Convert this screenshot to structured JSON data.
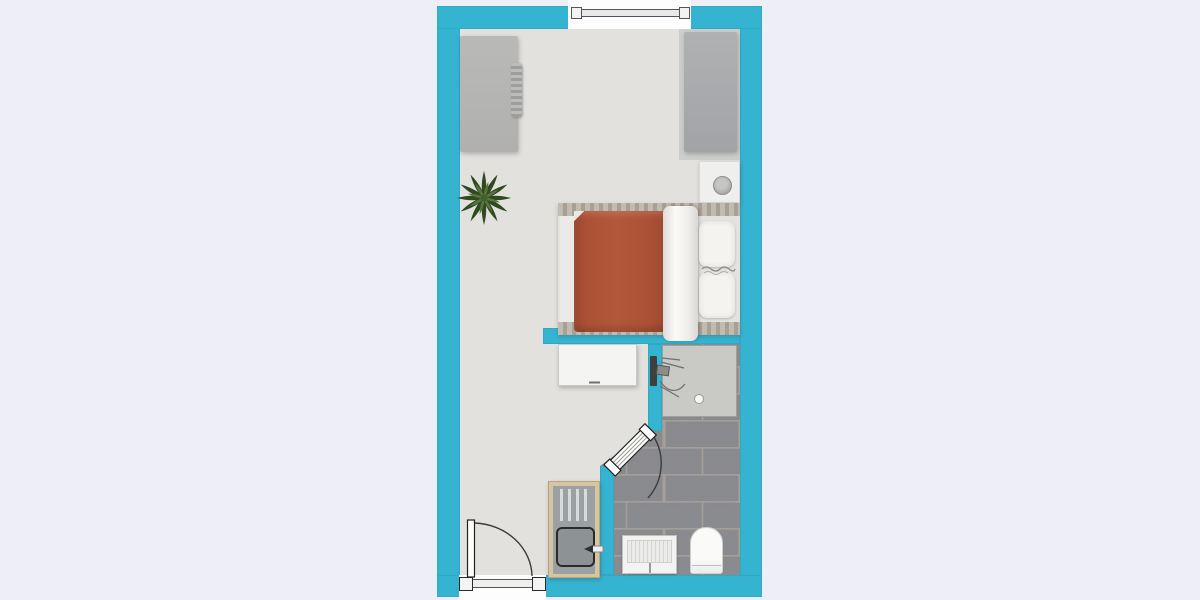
{
  "floorplan": {
    "type": "studio-apartment-floor-plan-top-view",
    "colors": {
      "page-bg": "#edeef6",
      "wall": "#35b4d2",
      "floor": "#e2e1de",
      "tile": "#8b8c90",
      "grout": "#a8a29a",
      "shower-floor": "#c9cac6",
      "wood": "#b3aca0",
      "cabinet-wood": "#d5c5a0",
      "duvet": "#ad5136",
      "linen": "#f4f3f0",
      "plant-dark": "#2f4a1f",
      "plant-light": "#5a7440"
    },
    "rooms": [
      {
        "name": "main-room",
        "features": [
          "window",
          "entrance-door-with-swing",
          "wardrobe",
          "closet",
          "nightstand-with-lamp",
          "single-bed-with-orange-duvet",
          "white-blanket",
          "pillows",
          "desk",
          "potted-plant",
          "kitchenette-sink-unit-with-drainer"
        ]
      },
      {
        "name": "bathroom",
        "features": [
          "tiled-floor",
          "shower-area",
          "shower-fixture",
          "floor-drain",
          "washbasin",
          "toilet",
          "door-with-swing"
        ]
      }
    ]
  }
}
